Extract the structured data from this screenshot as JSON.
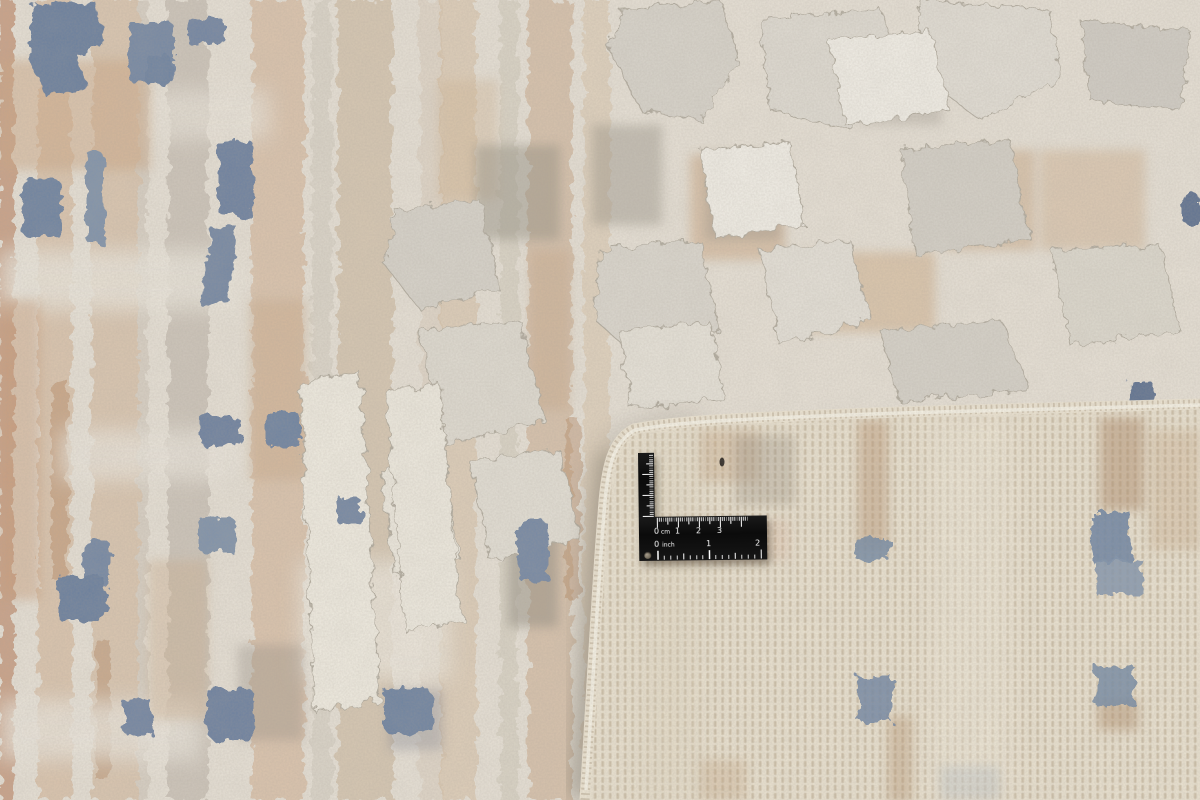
{
  "image": {
    "title": "Rug corner close-up with measuring square",
    "description": "Close-up photograph of a cream, grey, beige and steel-blue abstract high-low pile rug. The bottom-right corner is folded over, exposing the pale hand-knotted back with a whip-stitched cream binding, and a black L-shaped metal ruler with centimetre and inch scales lies on the exposed back.",
    "elements": {
      "rug_front": "Abstract striped and blocky pile in cream, grey, tan and rust with scattered steel-blue patches",
      "rug_back": "Pale cream woven back showing knot grid with faint tan and blue squares",
      "folded_corner": "Corner folded upward with bound serged edge and soft shadow beneath",
      "ruler": "Black L-shaped measuring square with white markings"
    }
  },
  "ruler": {
    "cm_scale": {
      "zero": "0",
      "unit": "cm",
      "marks": [
        "1",
        "2",
        "3"
      ]
    },
    "inch_scale": {
      "zero": "0",
      "unit": "inch",
      "marks": [
        "1",
        "2"
      ]
    }
  },
  "palette": {
    "front_base": "#e8e2d7",
    "front_grey": "#d7d3ca",
    "tan": "#cfa88a",
    "rust": "#c2926f",
    "steel_blue": "#6e83a1",
    "back_base": "#ece4d2",
    "binding": "#f3ecdc",
    "shadow": "#6b6354",
    "ruler_black": "#101010",
    "ruler_markings": "#ffffff"
  }
}
